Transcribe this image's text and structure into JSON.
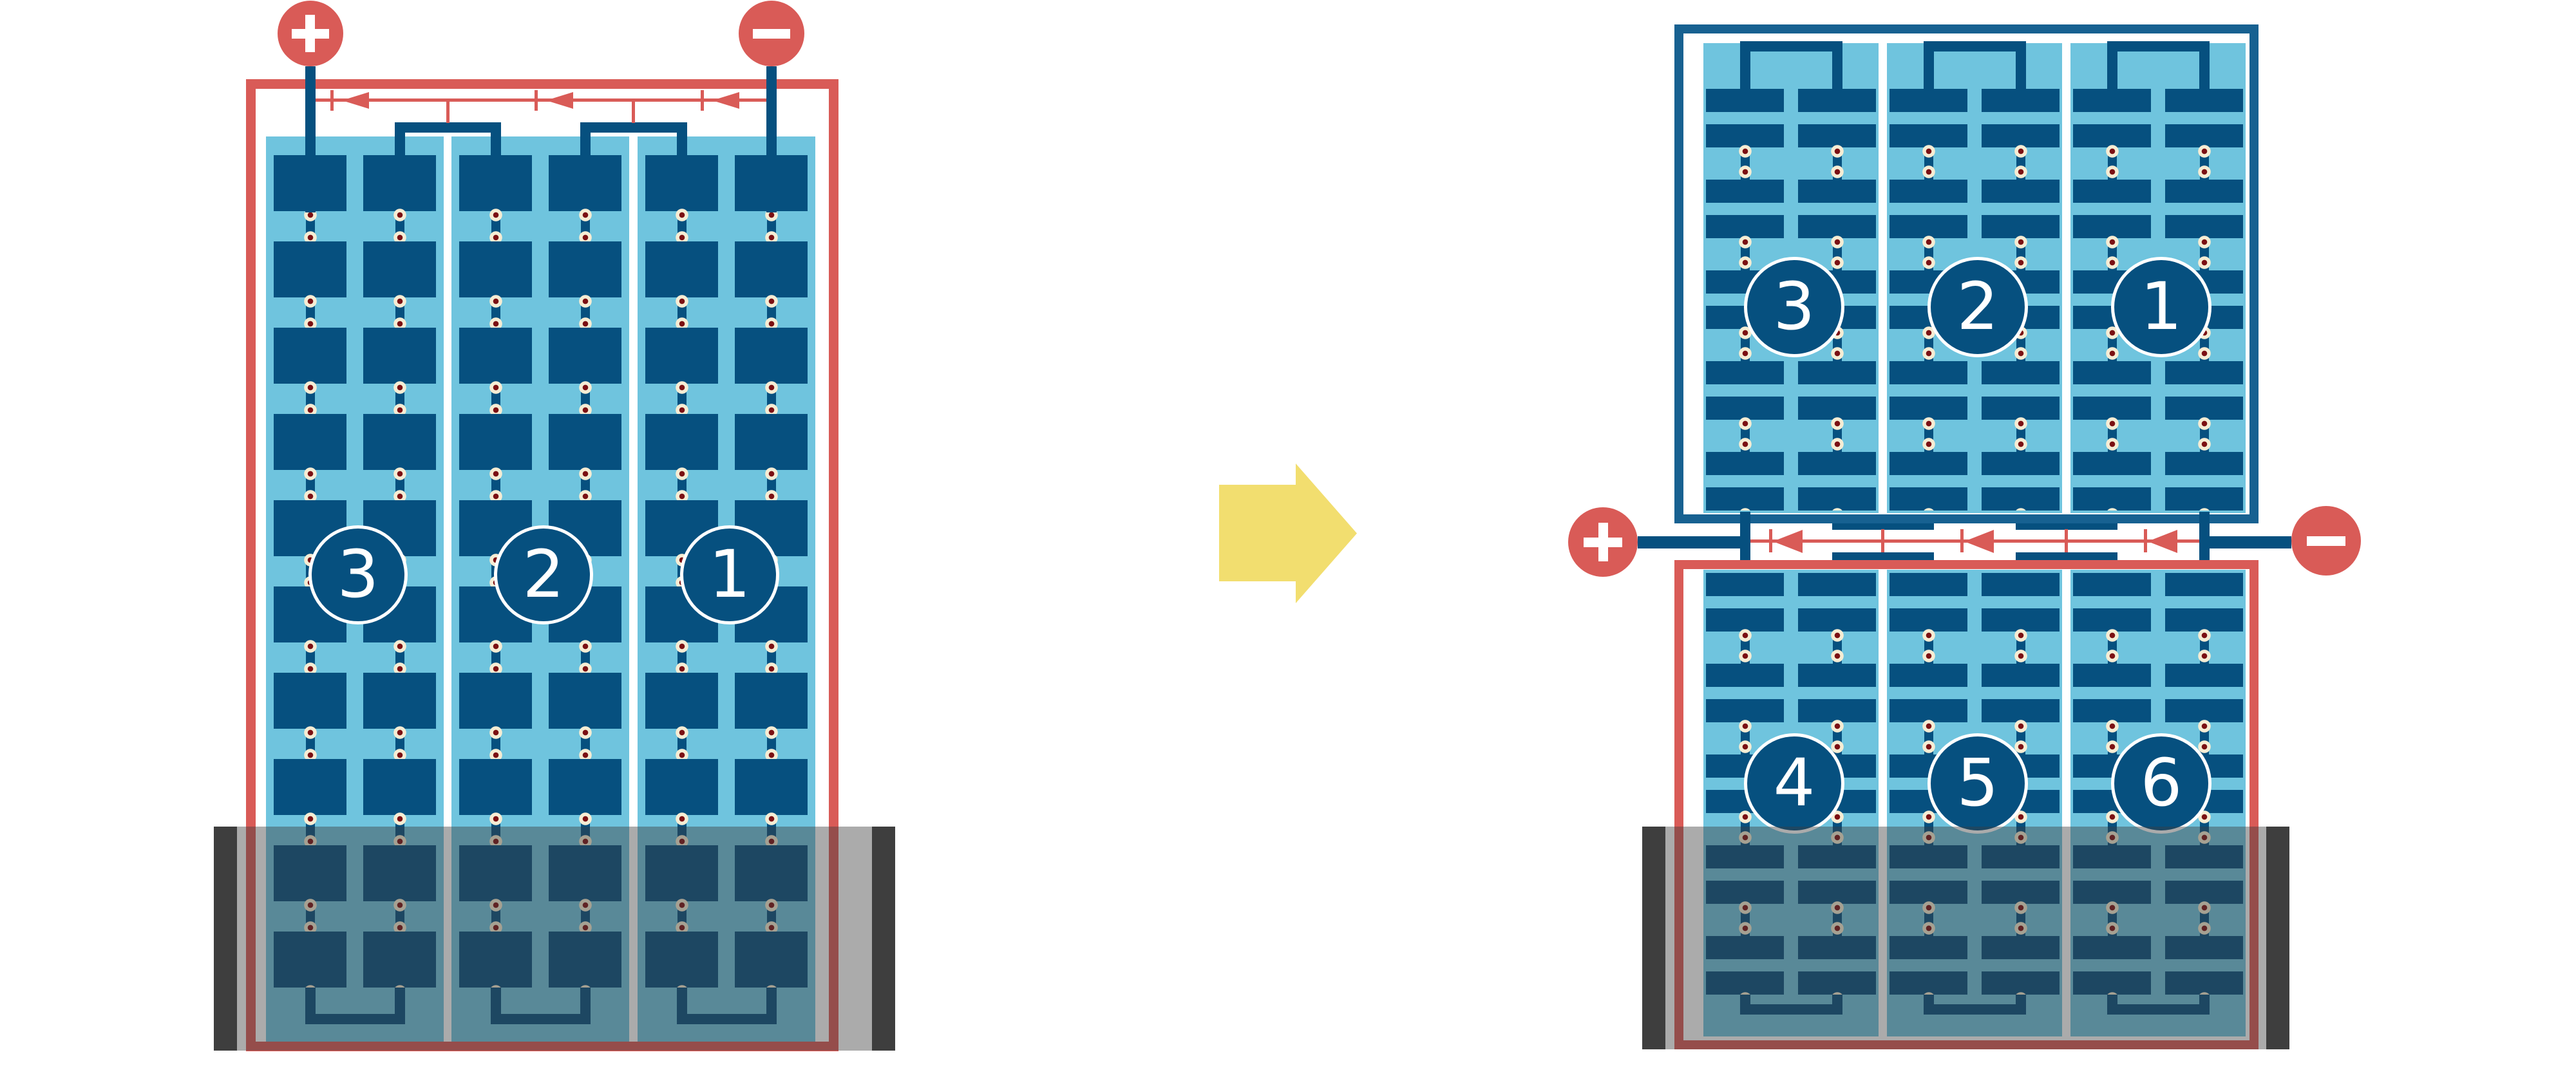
{
  "colors": {
    "red": "#D95B57",
    "dkblue": "#06507F",
    "frameblue": "#176191",
    "ltblue": "#6FC4DE",
    "cream": "#F6EDD4",
    "dotred": "#7B1013",
    "yellow": "#F2DE6F",
    "graybar": "#3E3E3E",
    "overlay": "rgba(61,61,61,0.43)",
    "bg": "#FFFFFF"
  },
  "before_battery": {
    "terminal_positive_symbol": "+",
    "terminal_negative_symbol": "-",
    "cell_labels": [
      "3",
      "2",
      "1"
    ],
    "current_arrow_direction": "left"
  },
  "after_battery": {
    "terminal_positive_symbol": "+",
    "terminal_negative_symbol": "-",
    "top_row_cell_labels": [
      "3",
      "2",
      "1"
    ],
    "bottom_row_cell_labels": [
      "4",
      "5",
      "6"
    ],
    "current_arrow_direction": "left"
  },
  "transition_arrow": {
    "direction": "right"
  }
}
